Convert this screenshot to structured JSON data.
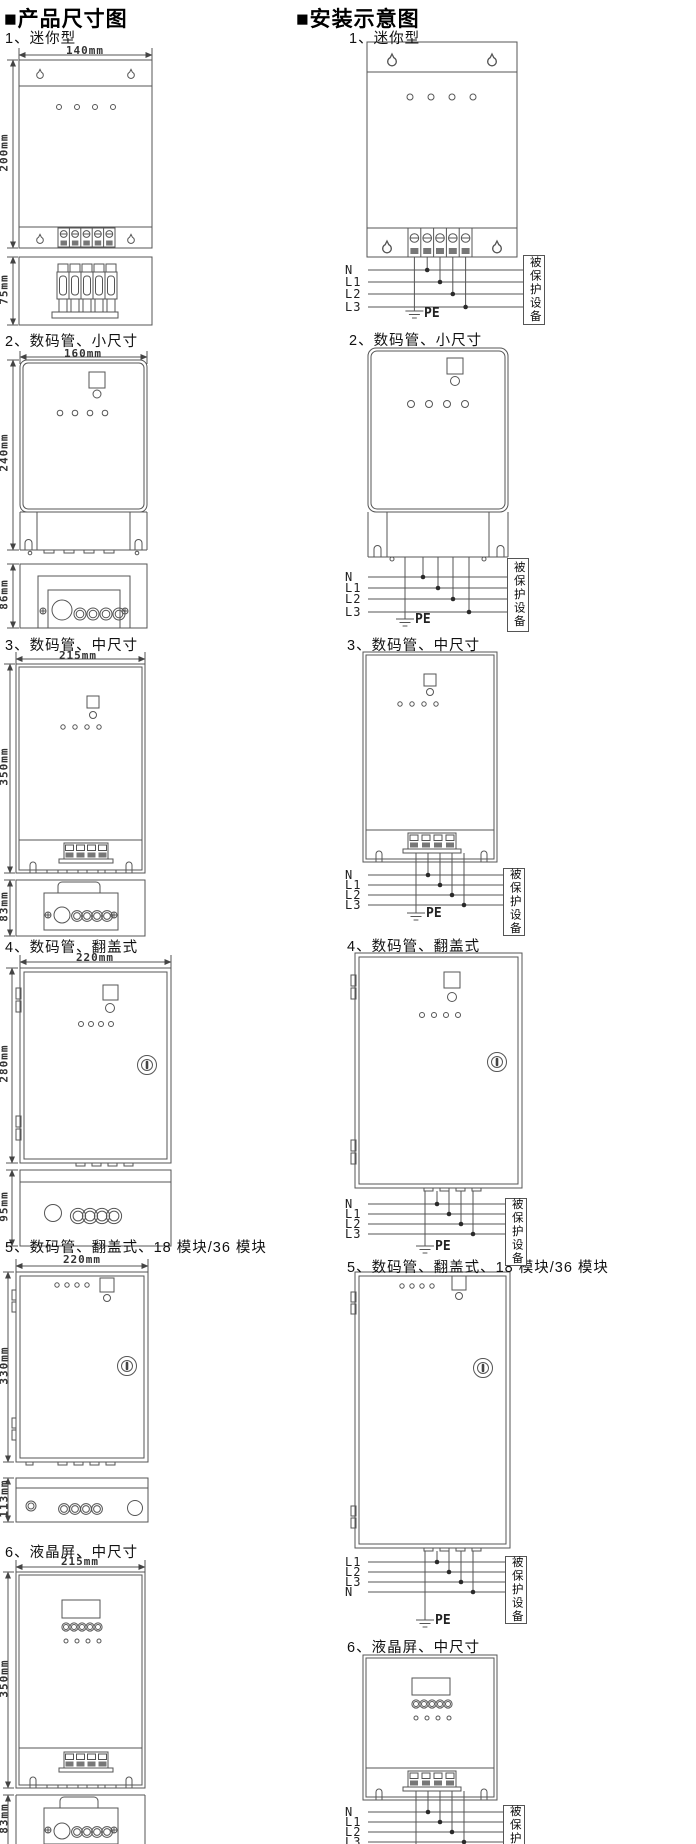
{
  "colors": {
    "line": "#555555",
    "dark_fill": "#777777",
    "text": "#111111"
  },
  "left": {
    "title": "■产品尺寸图",
    "sections": [
      {
        "label": "1、迷你型",
        "front_width": "140mm",
        "front_height": "200mm",
        "side_height": "75mm"
      },
      {
        "label": "2、数码管、小尺寸",
        "front_width": "160mm",
        "front_height": "240mm",
        "side_height": "86mm"
      },
      {
        "label": "3、数码管、中尺寸",
        "front_width": "215mm",
        "front_height": "350mm",
        "side_height": "83mm"
      },
      {
        "label": "4、数码管、翻盖式",
        "front_width": "220mm",
        "front_height": "280mm",
        "side_height": "95mm"
      },
      {
        "label": "5、数码管、翻盖式、18 模块/36 模块",
        "front_width": "220mm",
        "front_height": "330mm",
        "side_height": "113mm"
      },
      {
        "label": "6、液晶屏、中尺寸",
        "front_width": "215mm",
        "front_height": "350mm",
        "side_height": "83mm"
      }
    ]
  },
  "right": {
    "title": "■安装示意图",
    "pe": "PE",
    "protected": "被保护设备",
    "sections": [
      {
        "label": "1、迷你型",
        "wires": [
          "N",
          "L1",
          "L2",
          "L3"
        ]
      },
      {
        "label": "2、数码管、小尺寸",
        "wires": [
          "N",
          "L1",
          "L2",
          "L3"
        ]
      },
      {
        "label": "3、数码管、中尺寸",
        "wires": [
          "N",
          "L1",
          "L2",
          "L3"
        ]
      },
      {
        "label": "4、数码管、翻盖式",
        "wires": [
          "N",
          "L1",
          "L2",
          "L3"
        ]
      },
      {
        "label": "5、数码管、翻盖式、18 模块/36 模块",
        "wires": [
          "L1",
          "L2",
          "L3",
          "N"
        ]
      },
      {
        "label": "6、液晶屏、中尺寸",
        "wires": [
          "N",
          "L1",
          "L2",
          "L3"
        ]
      }
    ]
  }
}
